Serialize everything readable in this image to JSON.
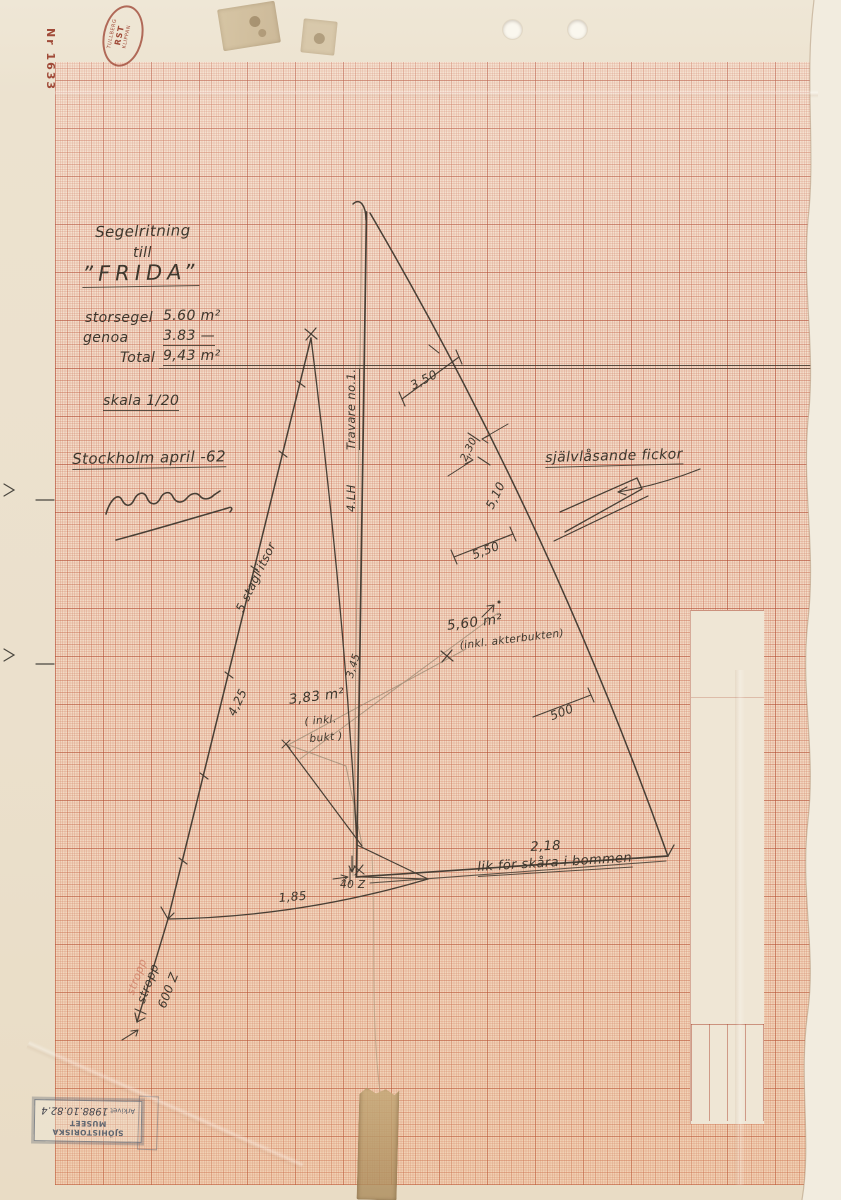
{
  "paper": {
    "stamp_number": "Nr 1633",
    "manufacturer_stamp": {
      "line1": "TULLBERG",
      "line2": "RST",
      "line3": "KLIPPAN"
    }
  },
  "title_block": {
    "heading_line1": "Segelritning",
    "heading_line2": "till",
    "boat_name": "”FRIDA”",
    "mainsail_label": "storsegel",
    "mainsail_value": "5.60 m²",
    "genoa_label": "genoa",
    "genoa_value": "3.83 —",
    "total_label": "Total",
    "total_value": "9,43 m²",
    "scale_note": "skala 1/20",
    "place_date": "Stockholm april -62"
  },
  "mast_labels": {
    "upper": "Travare no.1.",
    "lower": "4.LH"
  },
  "genoa": {
    "hanks_note": "5 stagl'itsor",
    "luff_length": "4,25",
    "area": "3,83 m²",
    "area_note1": "( inkl.",
    "area_note2": "bukt )",
    "foot_length": "1,85",
    "leech_length": "3,45",
    "stropp_label": "stropp",
    "stropp_label_red": "stropp",
    "stropp_value": "600 Z"
  },
  "mainsail": {
    "area": "5,60 m²",
    "area_note": "(inkl. akterbukten)",
    "dim_350": "3,50",
    "dim_230": "2,30",
    "dim_510": "5,10",
    "dim_550": "5,50",
    "dim_500": "500",
    "foot_dim": "2,18",
    "boom_note": "lik för skåra i bommen",
    "tack_dim": "40 Z"
  },
  "notes": {
    "pockets": "självlåsande fickor"
  },
  "archive_stamp": {
    "museum": "SJÖHISTORISKA MUSEET",
    "label": "Arkivet",
    "number": "1988.10.82.4"
  },
  "colors": {
    "pencil": "#483f35",
    "grid_major": "#b05a44",
    "stamp_red": "#a04a38",
    "stamp_grey": "#606874"
  }
}
